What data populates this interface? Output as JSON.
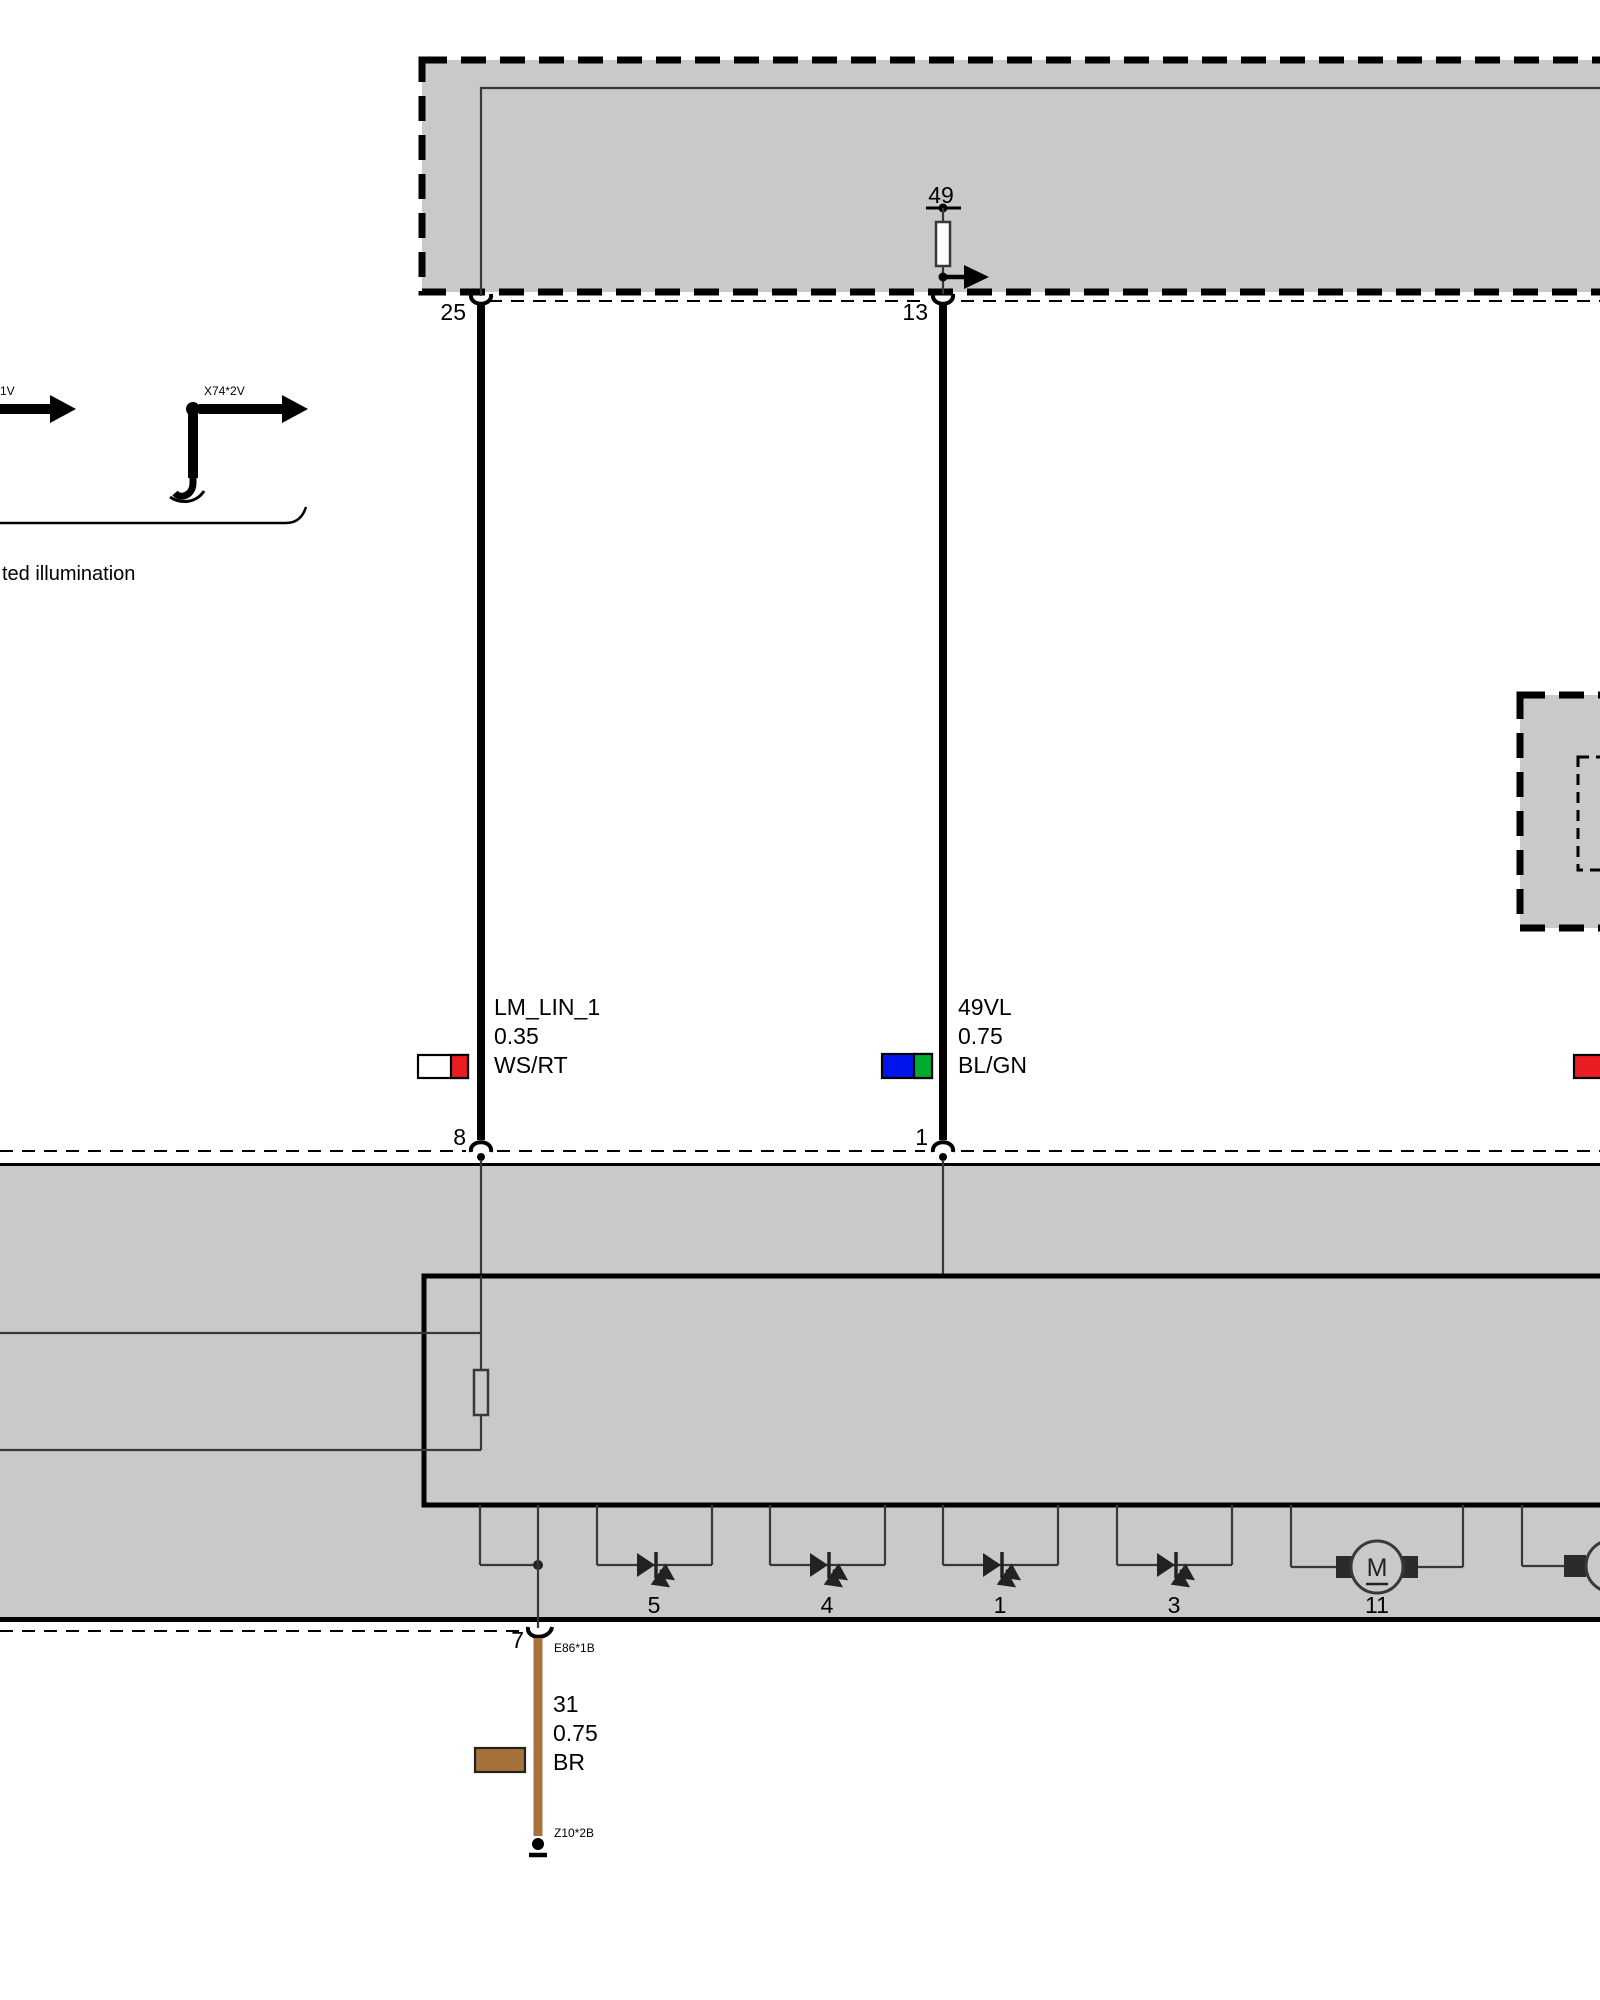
{
  "colors": {
    "module_fill": "#C9C9C9",
    "white": "#FFFFFF",
    "red": "#EC1C24",
    "blue": "#0014EB",
    "green": "#00AC32",
    "brown": "#A7713B"
  },
  "top_module": {
    "terminal_49": "49",
    "pin_25": "25",
    "pin_13": "13"
  },
  "ref_arrows": {
    "left_label": "1V",
    "right_label": "X74*2V",
    "caption": "ted illumination"
  },
  "wires": {
    "lm_lin": {
      "name": "LM_LIN_1",
      "gauge": "0.35",
      "code": "WS/RT",
      "pin_bottom": "8"
    },
    "vl49": {
      "name": "49VL",
      "gauge": "0.75",
      "code": "BL/GN",
      "pin_bottom": "1"
    },
    "ground": {
      "name": "31",
      "gauge": "0.75",
      "code": "BR",
      "pin_top": "7",
      "connector_top": "E86*1B",
      "connector_bottom": "Z10*2B"
    }
  },
  "loads": {
    "led_labels": [
      "5",
      "4",
      "1",
      "3"
    ],
    "motor_label": "11",
    "motor_letter": "M"
  }
}
